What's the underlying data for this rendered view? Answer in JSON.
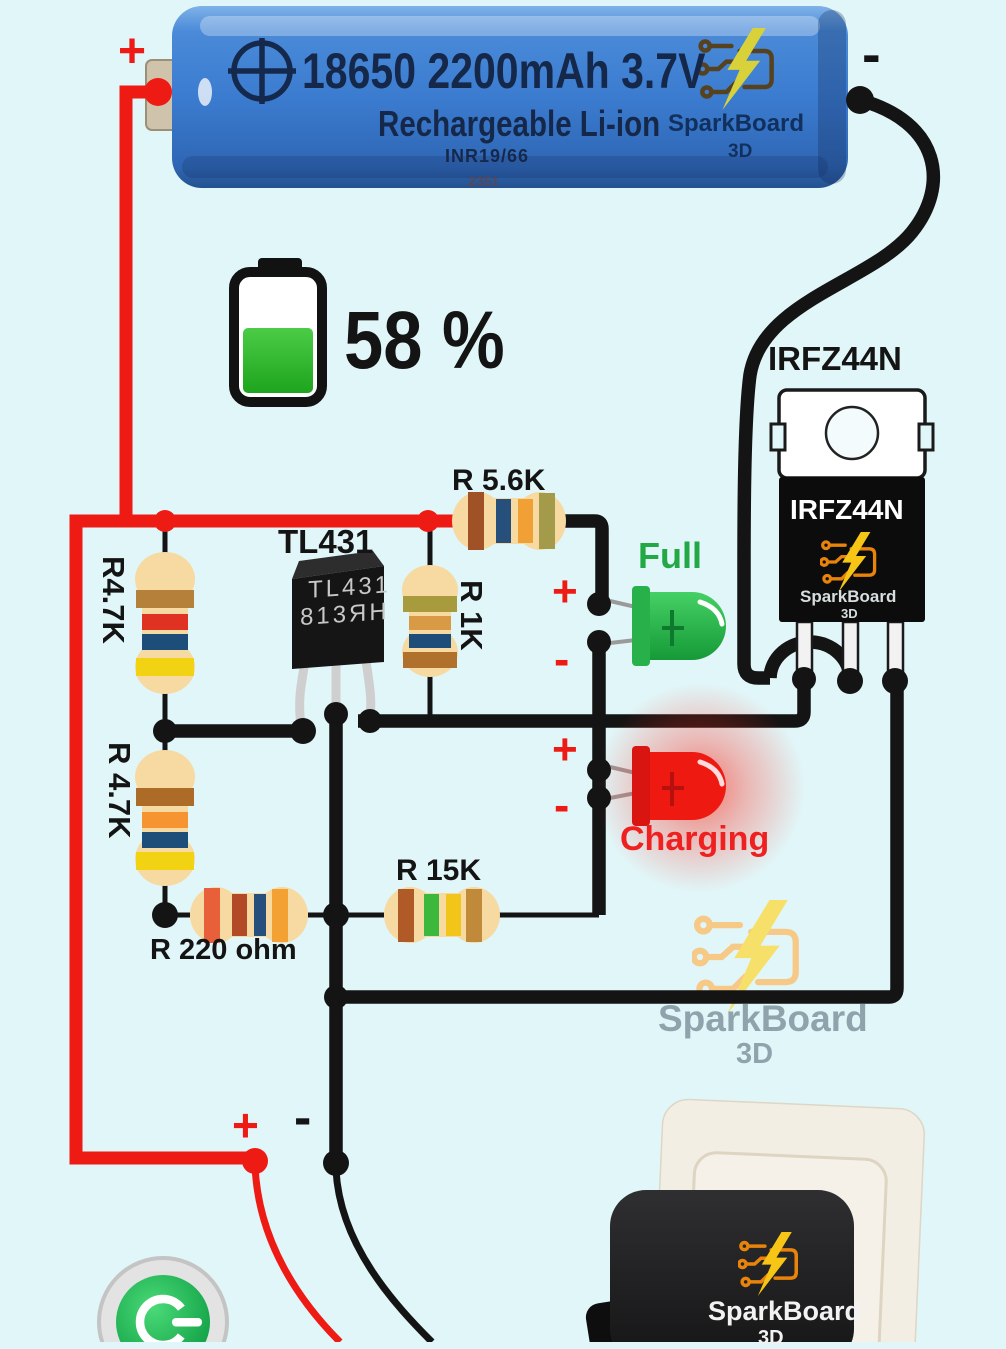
{
  "colors": {
    "background": "#e1f6f8",
    "wire_positive": "#ee1b14",
    "wire_negative": "#141414",
    "full_led": "#2dbf4e",
    "charging_led": "#ee1a12",
    "indicator_fill": "#2eb22e",
    "watermark_gray": "#8fa3ad",
    "brand_orange": "#e8830c",
    "brand_yellow": "#f7c51e"
  },
  "battery": {
    "plus": "+",
    "minus": "-",
    "line1": "18650 2200mAh 3.7V",
    "line2": "Rechargeable Li-ion",
    "line3": "INR19/66",
    "line4": "2351",
    "brand": "SparkBoard",
    "brand_sub": "3D"
  },
  "indicator": {
    "value": "58 %",
    "percent": 58
  },
  "mosfet": {
    "title": "IRFZ44N",
    "marking": "IRFZ44N",
    "brand": "SparkBoard",
    "brand_sub": "3D"
  },
  "tl431": {
    "title": "TL431",
    "marking_line1": "TL431",
    "marking_line2": "813ЯН"
  },
  "resistors": {
    "r47k_1": {
      "label": "R4.7K",
      "bands": [
        "#b5803a",
        "#e03222",
        "#1d4e79",
        "#f2d313"
      ]
    },
    "r47k_2": {
      "label": "R 4.7K",
      "bands": [
        "#ad6b28",
        "#f59430",
        "#1d4e79",
        "#f2d313"
      ]
    },
    "r1k": {
      "label": "R 1K",
      "bands": [
        "#a89b3d",
        "#d89a44",
        "#1d4e79",
        "#b0712c"
      ]
    },
    "r56k": {
      "label": "R 5.6K",
      "bands": [
        "#a05226",
        "#274f7c",
        "#f0a035",
        "#a39a4a"
      ]
    },
    "r220": {
      "label": "R 220 ohm",
      "bands": [
        "#e8603a",
        "#b24a28",
        "#274f7c",
        "#f2a132"
      ]
    },
    "r15k": {
      "label": "R 15K",
      "bands": [
        "#b05a28",
        "#3cb93c",
        "#f2c51a",
        "#c08a3a"
      ]
    }
  },
  "led_full": {
    "title": "Full",
    "plus": "+",
    "minus": "-"
  },
  "led_charging": {
    "title": "Charging",
    "plus": "+",
    "minus": "-"
  },
  "output": {
    "plus": "+",
    "minus": "-"
  },
  "watermark": {
    "brand": "SparkBoard",
    "sub": "3D"
  },
  "charger": {
    "brand": "SparkBoard",
    "sub": "3D"
  }
}
